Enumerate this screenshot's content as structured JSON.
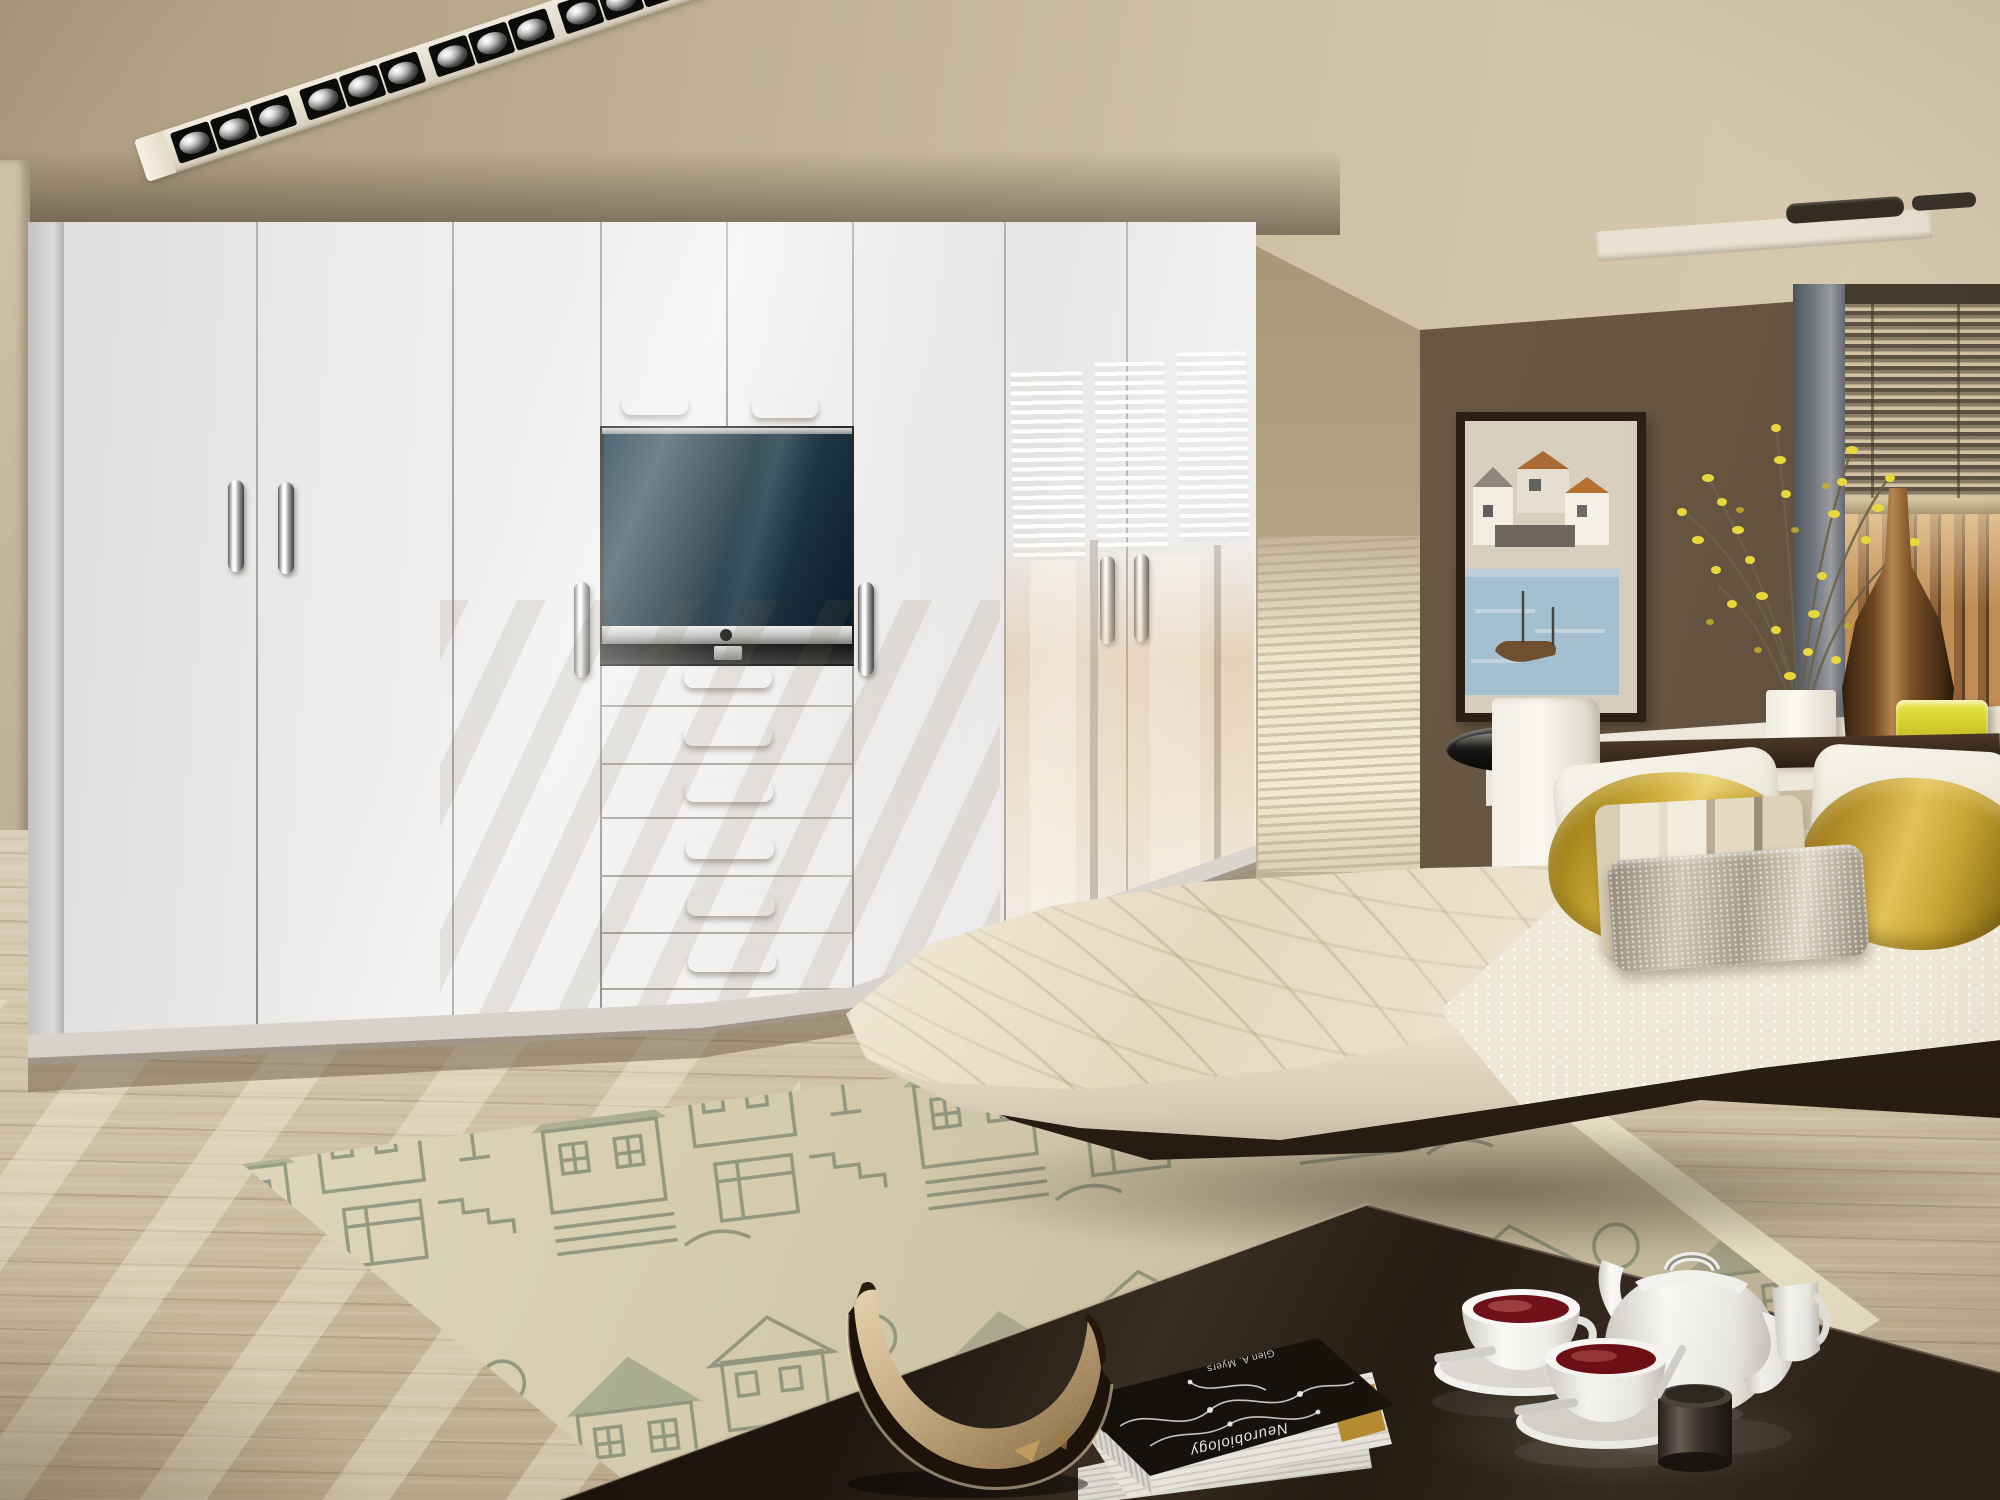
{
  "meta": {
    "description": "3D render photograph of a modern bedroom with a wall of white high-gloss fitted wardrobes, a recessed TV with drawers, a floating bed with gold pillows, a patterned rug and a dark coffee table with a white tea set",
    "room_type": "bedroom"
  },
  "palette": {
    "ceiling_tan": "#c7b99d",
    "wardrobe_white": "#eceae8",
    "chrome": "#d7d8d8",
    "tv_screen": "#16313e",
    "wall_brown": "#6d5c47",
    "wall_tan": "#bfb196",
    "floor_wood": "#cdbfa4",
    "rug_base": "#d9d2b8",
    "rug_pattern": "#8b9178",
    "bedding_cream": "#f1e9d8",
    "pillow_gold": "#c8a233",
    "table_dark": "#241c14",
    "tea_red": "#701018",
    "accent_yellow": "#d6cf2e"
  },
  "ceiling": {
    "light_track": {
      "spot_count": 12,
      "spot_finish": "chrome",
      "recess_finish": "black squares in white channel"
    },
    "vent_count": 2
  },
  "wardrobe": {
    "finish": "white high gloss",
    "tall_door_count": 6,
    "top_cabinet_count": 2,
    "drawer_count": 6,
    "handle_finish": "polished chrome",
    "tv": {
      "state": "off",
      "screen_color": "#16313e",
      "frame": "silver"
    }
  },
  "right_wall": {
    "artwork": {
      "subject": "coastal village painting with houses and a boat",
      "frame": "dark wood"
    },
    "window": {
      "covering": "venetian blind, half raised",
      "view": "timber slat screen"
    }
  },
  "bed": {
    "style": "floating platform bed",
    "pillow_count": 6,
    "pillows": [
      "white pillow",
      "white pillow",
      "gold satin pillow",
      "gold satin pillow",
      "cream striped cushion",
      "silver textured cushion"
    ],
    "headboard": "white gloss panel with dark wood rail"
  },
  "side_table": {
    "type": "chrome pedestal table with black round top"
  },
  "rug": {
    "pattern": "village houses line drawing",
    "colors": "sage grey on beige"
  },
  "coffee_table": {
    "finish": "dark brown high gloss",
    "items": [
      "white teapot",
      "milk jug",
      "dark sugar bowl with spoon",
      "cup of red tea",
      "cup of red tea"
    ]
  },
  "books": {
    "count": 3,
    "top_title": "Neurobiology",
    "top_author": "Glen A. Myers"
  },
  "sculpture": {
    "type": "curved horn bowl",
    "finish": "hammered bronze metal"
  },
  "sill_items": [
    "white vase with yellow forsythia branches",
    "brown glass bottle vase",
    "yellow tumbler"
  ]
}
